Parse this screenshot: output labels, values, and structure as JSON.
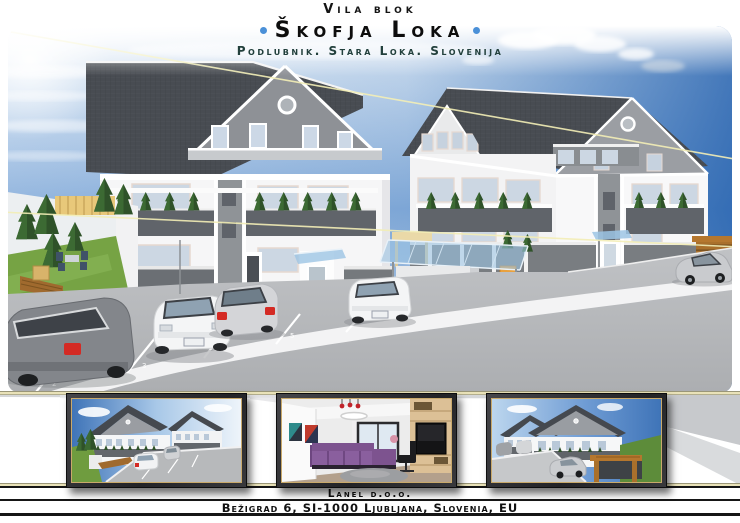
{
  "header": {
    "pretitle": "Vila blok",
    "title": "Škofja Loka",
    "subtitle": "Podlubnik. Stara Loka. Slovenija"
  },
  "main_render": {
    "parking_numbers": [
      "2",
      "3",
      "4",
      "5"
    ]
  },
  "footer": {
    "company": "Lanel d.o.o.",
    "address": "Bežigrad 6, SI-1000 Ljubljana, Slovenia, EU"
  },
  "colors": {
    "accent_dot_blue": "#4a90d8",
    "subtitle_teal": "#22403c",
    "gold_rule": "#e9e2b8",
    "frame_dark": "#232326",
    "frame_gold": "#c9a96a",
    "sky_blue": "#3f74b8",
    "roof_gray": "#4b4f55",
    "wall_white": "#f6f6f7",
    "balcony_gray": "#60646a",
    "asphalt_gray": "#b4b6b8",
    "grass_green": "#6f9c3f",
    "wood_brown": "#a9702c",
    "sofa_purple": "#8a5f9e",
    "canopy_glass_blue": "#9cc4e4",
    "taillight_red": "#d42a24"
  }
}
